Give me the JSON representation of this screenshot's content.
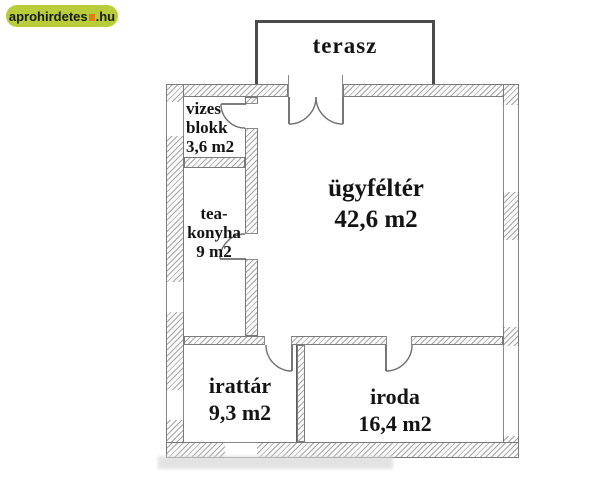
{
  "watermark": {
    "site": "aprohirdetes",
    "tld": ".hu",
    "bg_color": "#b9cc3a",
    "mark_color": "#e87a10"
  },
  "rooms": {
    "terasz": {
      "name": "terasz"
    },
    "vizes_blokk": {
      "line1": "vizes",
      "line2": "blokk",
      "area": "3,6 m2"
    },
    "tea_konyha": {
      "line1": "tea-",
      "line2": "konyha",
      "area": "9 m2"
    },
    "ugyfelter": {
      "name": "ügyféltér",
      "area": "42,6 m2"
    },
    "irattar": {
      "name": "irattár",
      "area": "9,3 m2"
    },
    "iroda": {
      "name": "iroda",
      "area": "16,4 m2"
    }
  }
}
